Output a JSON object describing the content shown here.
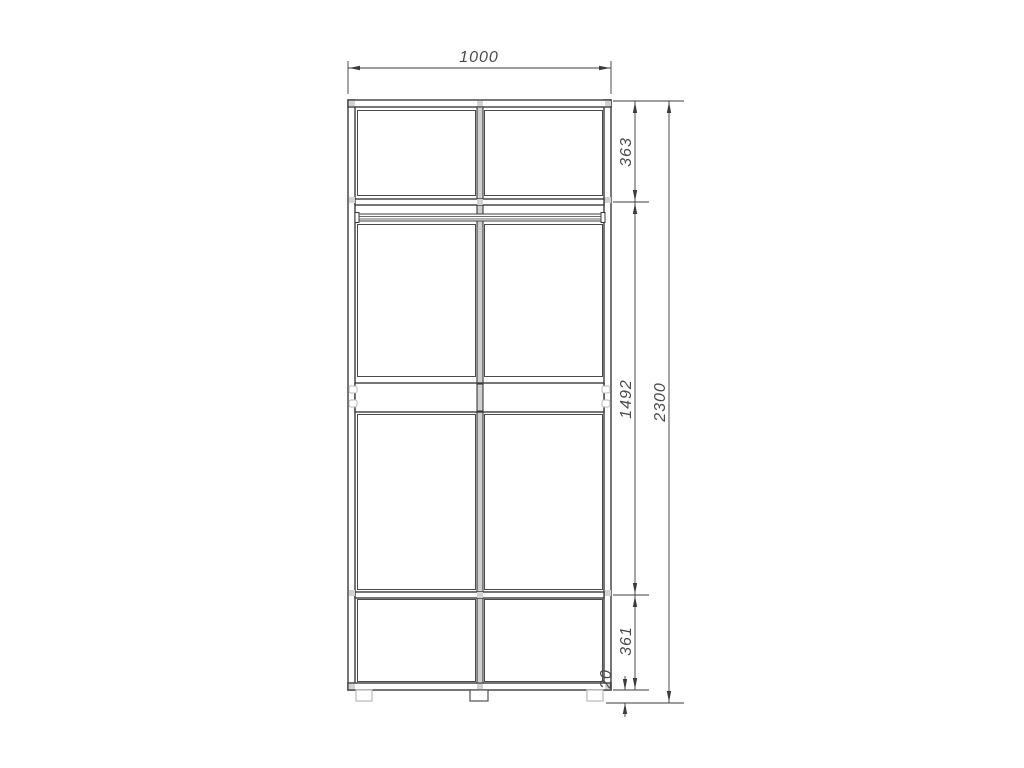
{
  "drawing": {
    "kind": "cabinet-front-elevation",
    "dimensions": {
      "overall_width": "1000",
      "overall_height": "2300",
      "top_section_height": "363",
      "middle_section_height": "1492",
      "bottom_section_height": "361",
      "foot_height": "20"
    },
    "colors": {
      "bg": "#ffffff",
      "line": "#3b3b3b",
      "dim": "#3b3b3b",
      "text": "#4a4a4a",
      "light": "#b9b9b9",
      "joint": "#d2d2d2",
      "panel": "#cfcfcf"
    }
  }
}
